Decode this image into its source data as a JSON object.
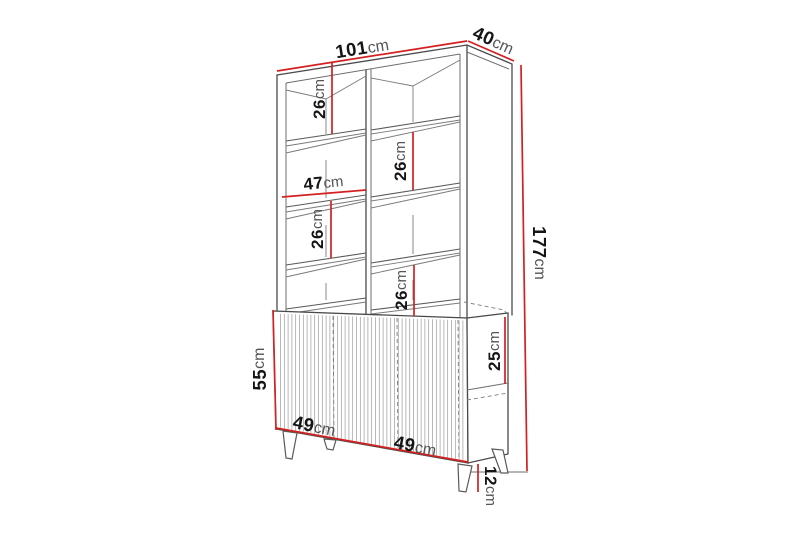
{
  "diagram": {
    "name": "display-cabinet-dimension-diagram",
    "unit": "cm",
    "colors": {
      "background": "#ffffff",
      "outline": "#4a4a4a",
      "dimension_line": "#d42020",
      "number_text": "#151515",
      "unit_text": "#555555"
    },
    "labels": {
      "total_width": {
        "num": "101",
        "unit": "cm"
      },
      "total_depth": {
        "num": "40",
        "unit": "cm"
      },
      "total_height": {
        "num": "177",
        "unit": "cm"
      },
      "gap_left_top": {
        "num": "26",
        "unit": "cm"
      },
      "gap_right_top": {
        "num": "26",
        "unit": "cm"
      },
      "shelf_width": {
        "num": "47",
        "unit": "cm"
      },
      "gap_left_low": {
        "num": "26",
        "unit": "cm"
      },
      "gap_right_low": {
        "num": "26",
        "unit": "cm"
      },
      "base_height": {
        "num": "55",
        "unit": "cm"
      },
      "drawer_height": {
        "num": "25",
        "unit": "cm"
      },
      "door_width_1": {
        "num": "49",
        "unit": "cm"
      },
      "door_width_2": {
        "num": "49",
        "unit": "cm"
      },
      "leg_height": {
        "num": "12",
        "unit": "cm"
      }
    }
  }
}
